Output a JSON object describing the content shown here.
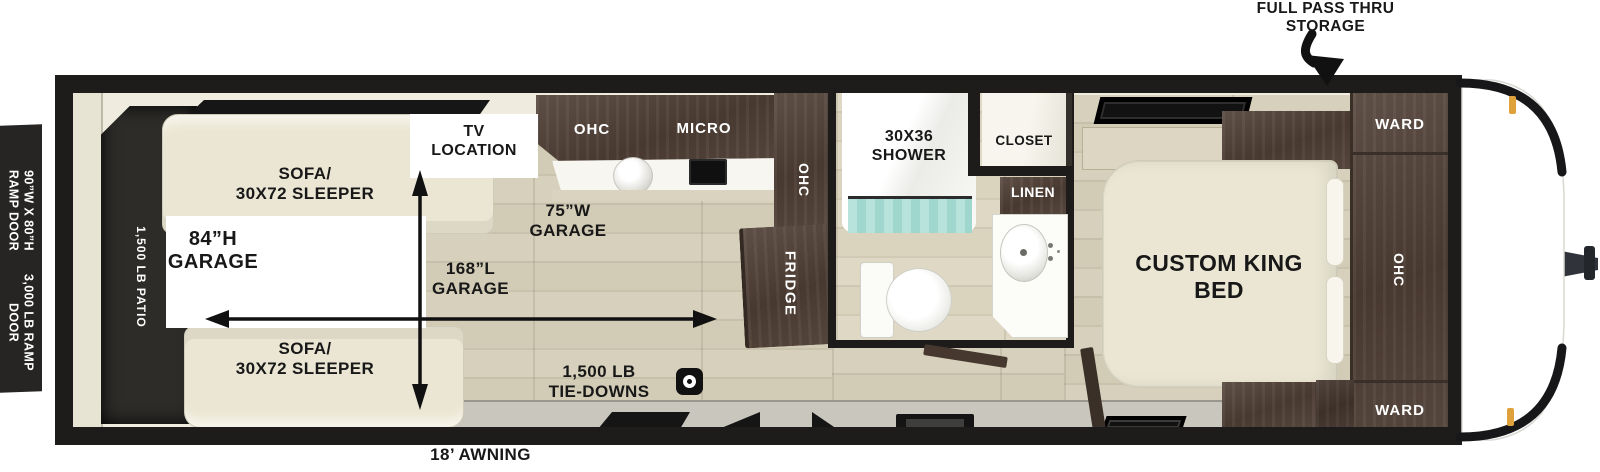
{
  "exterior": {
    "storage_callout": "FULL PASS THRU\nSTORAGE",
    "awning": "18’ AWNING",
    "ramp_door_size": "90”W X 80”H\nRAMP DOOR",
    "ramp_door_rating": "3,000 LB RAMP\nDOOR"
  },
  "garage": {
    "patio_rating": "1,500 LB PATIO",
    "sofa_top": "SOFA/\n30X72 SLEEPER",
    "sofa_bottom": "SOFA/\n30X72 SLEEPER",
    "height_label": "84”H\nGARAGE",
    "width_label": "75”W\nGARAGE",
    "length_label": "168”L\nGARAGE",
    "tie_downs": "1,500 LB\nTIE-DOWNS",
    "tv_location": "TV\nLOCATION"
  },
  "kitchen": {
    "ohc_top": "OHC",
    "micro": "MICRO",
    "ohc_side": "OHC",
    "fridge": "FRIDGE"
  },
  "bathroom": {
    "shower": "30X36\nSHOWER",
    "closet": "CLOSET",
    "linen": "LINEN"
  },
  "bedroom": {
    "bed": "CUSTOM KING\nBED",
    "ward_top": "WARD",
    "ward_bottom": "WARD",
    "ohc": "OHC"
  },
  "colors": {
    "wall": "#1d1c1a",
    "cabinet_brown": "#55463d",
    "floor_wood": "#d4cebb",
    "upholstery_cream": "#eae6d3",
    "patio_dark": "#2d2c29",
    "curtain_teal": "#b7e3dc",
    "marker_light": "#dfa13b"
  }
}
